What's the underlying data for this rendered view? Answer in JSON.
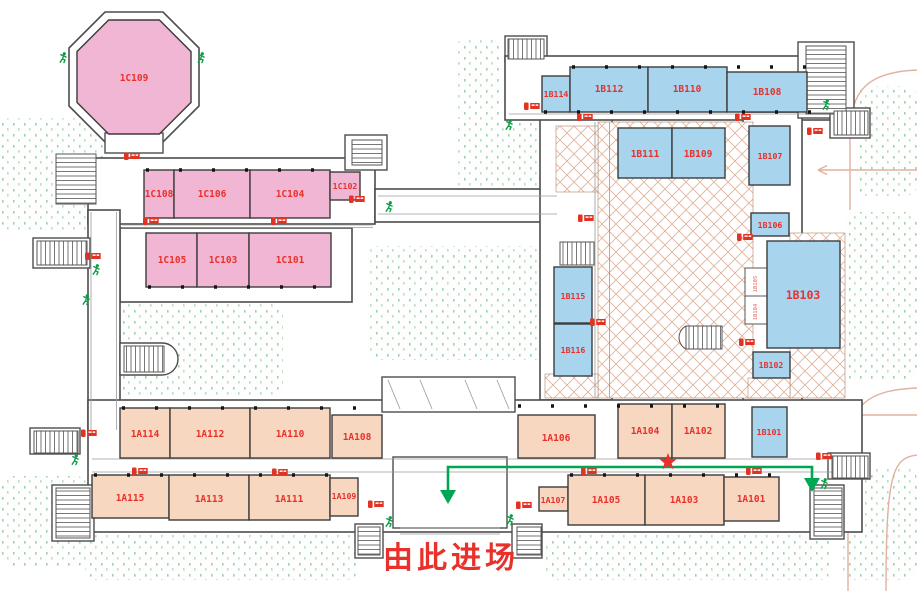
{
  "page": {
    "type": "exhibition-hall-floor-plan",
    "entrance_label": "由此进场"
  },
  "rooms": {
    "c109": "1C109",
    "c108": "1C108",
    "c106": "1C106",
    "c104": "1C104",
    "c102": "1C102",
    "c105": "1C105",
    "c103": "1C103",
    "c101": "1C101",
    "b114": "1B114",
    "b112": "1B112",
    "b110": "1B110",
    "b108": "1B108",
    "b111": "1B111",
    "b109": "1B109",
    "b107": "1B107",
    "b106": "1B106",
    "b105": "1B105",
    "b104": "1B104",
    "b103": "1B103",
    "b102": "1B102",
    "b101": "1B101",
    "b115": "1B115",
    "b116": "1B116",
    "a114": "1A114",
    "a112": "1A112",
    "a110": "1A110",
    "a108": "1A108",
    "a106": "1A106",
    "a104": "1A104",
    "a102": "1A102",
    "a115": "1A115",
    "a113": "1A113",
    "a111": "1A111",
    "a109": "1A109",
    "a107": "1A107",
    "a105": "1A105",
    "a103": "1A103",
    "a101": "1A101"
  },
  "colors": {
    "zone_a_fill": "#f8d7c0",
    "zone_b_fill": "#a9d4ee",
    "zone_c_fill": "#f0b6d3",
    "room_label": "#e8312b",
    "entrance_text": "#e8312b",
    "entry_path_green": "#00a651",
    "entry_star_red": "#e8312b",
    "exit_figure_green": "#0e9e46",
    "fire_equipment_red": "#e23222",
    "atrium_hatch": "#e2b098",
    "road_line": "#e0b2a0",
    "landscape_dots": "#9ed2ab",
    "wall": "#4d4d4d"
  },
  "icons": {
    "exit_runner": "emergency-exit running man",
    "fire_extinguisher": "fire extinguisher point",
    "entry_star": "entry point star",
    "entry_arrow": "entry route arrow"
  }
}
